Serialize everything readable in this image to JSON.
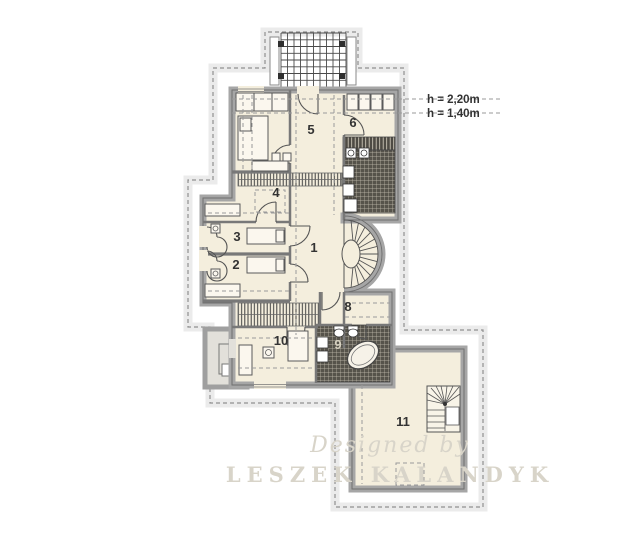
{
  "rooms": [
    {
      "label": "1"
    },
    {
      "label": "2"
    },
    {
      "label": "3"
    },
    {
      "label": "4"
    },
    {
      "label": "5"
    },
    {
      "label": "6"
    },
    {
      "label": "8"
    },
    {
      "label": "9"
    },
    {
      "label": "10"
    },
    {
      "label": "11"
    }
  ],
  "annotations": [
    {
      "label": "h = 2,20m"
    },
    {
      "label": "h = 1,40m"
    }
  ],
  "watermark": {
    "designed": "Designed by",
    "name": "LESZEK KALANDYK"
  },
  "colors": {
    "floor": "#f4eedd",
    "wall": "#a6a6a6",
    "wall_edge": "#6f6f6f",
    "tile_dark": "#56534b",
    "tile_line": "#c7c1b2",
    "roof_dash": "#8f8f8f",
    "guide_dash": "#9a9a9a",
    "label": "#333333",
    "watermark": "#d8d4c9",
    "terrace": "#e2e0da",
    "background": "#ffffff"
  }
}
